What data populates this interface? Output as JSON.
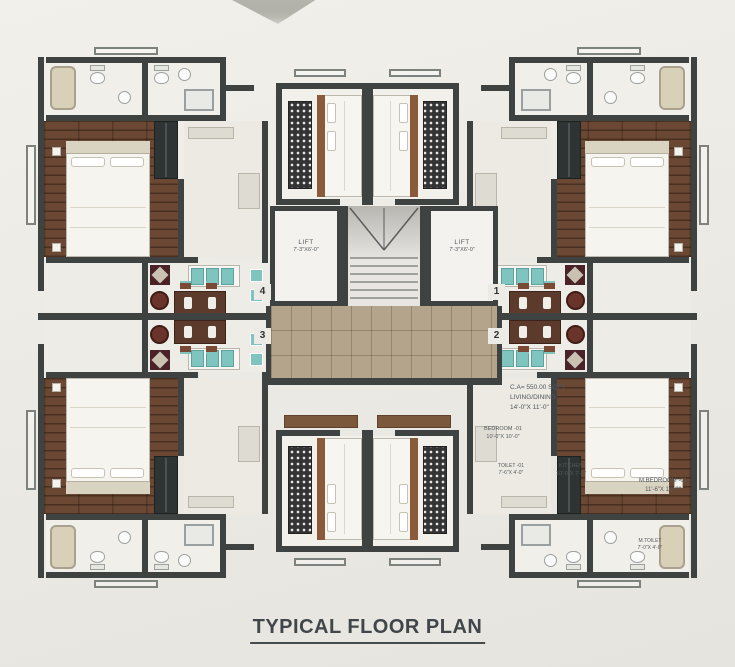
{
  "title": "TYPICAL FLOOR PLAN",
  "core": {
    "lift_left": {
      "label": "LIFT",
      "dims": "7'-3\"X6'-0\""
    },
    "lift_right": {
      "label": "LIFT",
      "dims": "7'-3\"X6'-0\""
    },
    "unit_numbers": {
      "top_left": "4",
      "bottom_left": "3",
      "top_right": "1",
      "bottom_right": "2"
    }
  },
  "labels": {
    "area_note": {
      "line1": "C.A= 550.00 SQFT",
      "line2": "LIVING/DINING",
      "line3": "14'-0\"X 11'-0\""
    },
    "bedroom": {
      "name": "BEDROOM -01",
      "dims": "10'-0\"X 10'-0\""
    },
    "toilet": {
      "name": "TOILET -01",
      "dims": "7'-6\"X 4'-0\""
    },
    "kitchen": {
      "name": "KITCHEN",
      "dims": "10'-0\"X 7'-6\""
    },
    "master_bedroom": {
      "name": "M.BEDROOM -01",
      "dims": "11'-6\"X 10'-0\""
    },
    "master_toilet": {
      "name": "M.TOILET",
      "dims": "7'-0\"X 4'-0\""
    }
  },
  "colors": {
    "background": "#ebe9e4",
    "wall": "#3e4342",
    "wood_floor": "#6a4833",
    "lobby_tile": "#b3a48b",
    "teal_accent": "#7fc4bf",
    "maroon_accent": "#4a2228",
    "text": "#54585b"
  }
}
